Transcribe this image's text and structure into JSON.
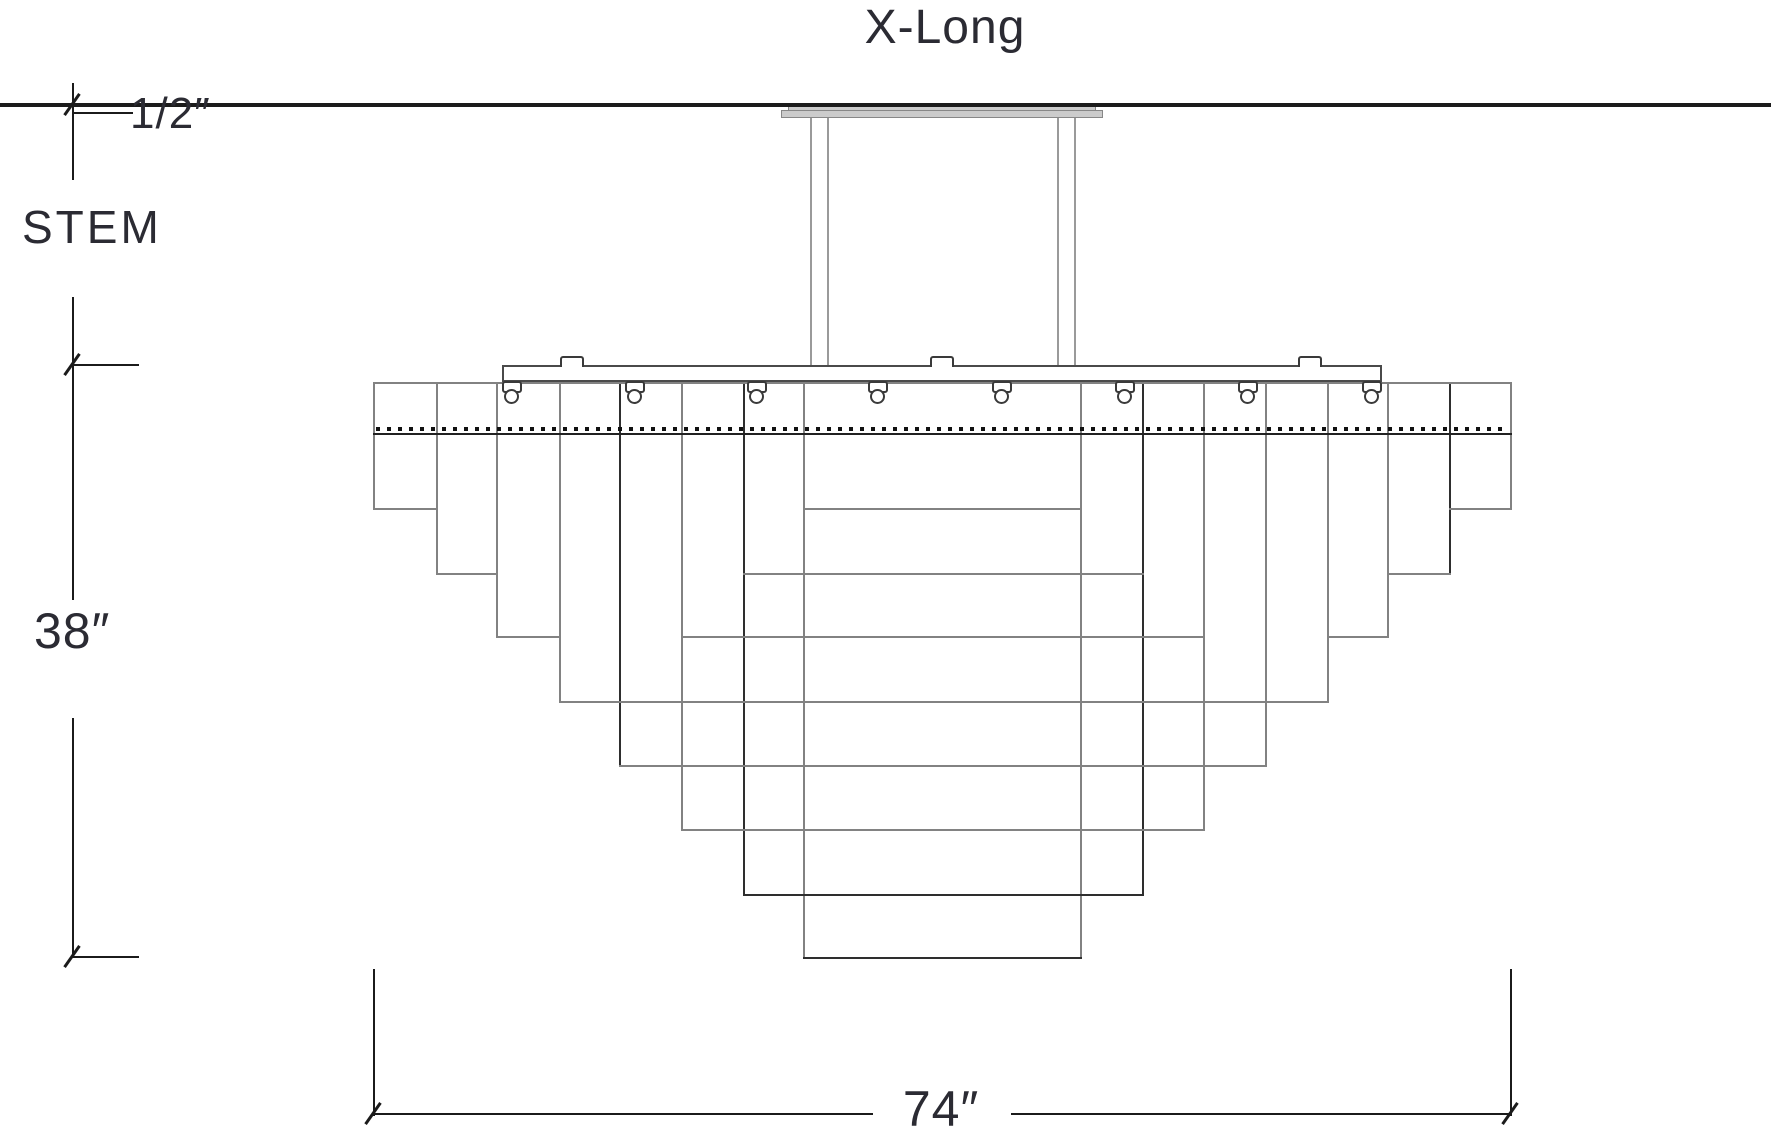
{
  "title": "X-Long",
  "labels": {
    "stem": "STEM",
    "stem_offset": "1/2″",
    "fixture_height": "38″",
    "fixture_width": "74″"
  },
  "colors": {
    "g": "#828282",
    "d": "#2e2e2e",
    "k": "#1b1b1b",
    "s": "#9a9a9a",
    "text": "#2b2b33",
    "canopy_fill": "#cbcbcb",
    "canopy_edge": "#878787",
    "clip_edge": "#3a3a3a",
    "dot": "#111111"
  },
  "drawing": {
    "ceiling_line": {
      "y": 103,
      "x1": 0,
      "x2": 1771,
      "h": 4
    },
    "dim_verticals": [
      [
        72,
        83,
        180
      ],
      [
        72,
        297,
        600
      ],
      [
        72,
        718,
        957
      ],
      [
        373,
        969,
        1116
      ],
      [
        1510,
        969,
        1116
      ]
    ],
    "dim_horizontals": [
      [
        112,
        73,
        131
      ],
      [
        364,
        72,
        137
      ],
      [
        956,
        72,
        137
      ],
      [
        1113,
        373,
        871
      ],
      [
        1113,
        1011,
        1510
      ]
    ],
    "ticks": [
      [
        72,
        104
      ],
      [
        72,
        364
      ],
      [
        72,
        956
      ],
      [
        373,
        1113
      ],
      [
        1510,
        1113
      ]
    ],
    "canopy_plates": [
      {
        "x": 788,
        "y": 106,
        "w": 308,
        "h": 5
      },
      {
        "x": 781,
        "y": 110,
        "w": 322,
        "h": 8
      }
    ],
    "stem_lines": [
      [
        810,
        118,
        366
      ],
      [
        827,
        118,
        366
      ],
      [
        1057,
        118,
        366
      ],
      [
        1074,
        118,
        366
      ]
    ],
    "bar": {
      "x": 502,
      "y": 365,
      "w": 880,
      "h": 17
    },
    "tier_line": {
      "y": 382,
      "x1": 373,
      "x2": 1510
    },
    "tabs": [
      572,
      942,
      1310
    ],
    "clips": [
      512,
      635,
      757,
      878,
      1002,
      1125,
      1248,
      1372
    ],
    "dotted_line": {
      "y": 427,
      "x1": 376,
      "x2": 1508
    },
    "hem_line": {
      "y": 433,
      "x1": 373,
      "x2": 1510
    },
    "panel_verticals": [
      [
        373,
        384,
        510,
        "g"
      ],
      [
        436,
        384,
        575,
        "g"
      ],
      [
        496,
        384,
        638,
        "g"
      ],
      [
        559,
        384,
        703,
        "g"
      ],
      [
        619,
        384,
        767,
        "d"
      ],
      [
        681,
        384,
        831,
        "g"
      ],
      [
        743,
        384,
        896,
        "d"
      ],
      [
        803,
        384,
        959,
        "g"
      ],
      [
        1510,
        384,
        510,
        "g"
      ],
      [
        1449,
        384,
        575,
        "d"
      ],
      [
        1387,
        384,
        638,
        "g"
      ],
      [
        1327,
        384,
        703,
        "g"
      ],
      [
        1265,
        384,
        767,
        "g"
      ],
      [
        1203,
        384,
        831,
        "g"
      ],
      [
        1142,
        384,
        896,
        "d"
      ],
      [
        1080,
        384,
        959,
        "g"
      ]
    ],
    "panel_horizontals": [
      [
        508,
        373,
        436,
        "g"
      ],
      [
        508,
        803,
        1080,
        "g"
      ],
      [
        508,
        1449,
        1510,
        "g"
      ],
      [
        573,
        436,
        496,
        "g"
      ],
      [
        573,
        743,
        1142,
        "g"
      ],
      [
        573,
        1387,
        1449,
        "g"
      ],
      [
        636,
        496,
        559,
        "g"
      ],
      [
        636,
        681,
        1203,
        "g"
      ],
      [
        636,
        1327,
        1387,
        "g"
      ],
      [
        701,
        559,
        1327,
        "g"
      ],
      [
        765,
        619,
        1265,
        "g"
      ],
      [
        829,
        681,
        1203,
        "g"
      ],
      [
        894,
        743,
        1142,
        "d"
      ],
      [
        957,
        803,
        1080,
        "d"
      ]
    ]
  }
}
